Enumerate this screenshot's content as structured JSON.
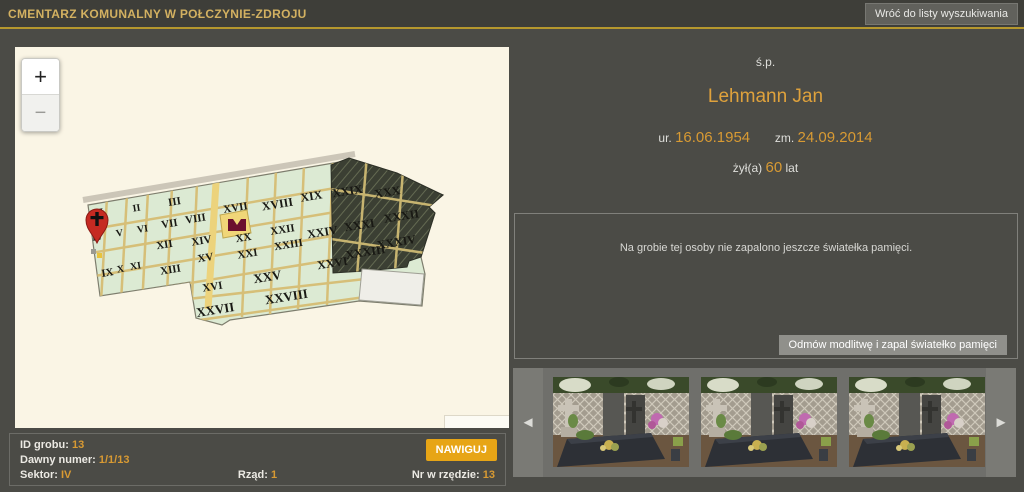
{
  "header": {
    "title": "CMENTARZ KOMUNALNY W POŁCZYNIE-ZDROJU",
    "back_button": "Wróć do listy wyszukiwania"
  },
  "map": {
    "zoom_in": "+",
    "zoom_out": "−",
    "marker_sector": "IV",
    "sectors": [
      {
        "label": "I",
        "x": 87,
        "y": 168,
        "s": 10
      },
      {
        "label": "II",
        "x": 122,
        "y": 164,
        "s": 10
      },
      {
        "label": "III",
        "x": 160,
        "y": 158,
        "s": 11
      },
      {
        "label": "IV",
        "x": 83,
        "y": 193,
        "s": 10
      },
      {
        "label": "V",
        "x": 105,
        "y": 189,
        "s": 10
      },
      {
        "label": "VI",
        "x": 128,
        "y": 185,
        "s": 10
      },
      {
        "label": "VII",
        "x": 155,
        "y": 180,
        "s": 11
      },
      {
        "label": "VIII",
        "x": 181,
        "y": 175,
        "s": 11
      },
      {
        "label": "IX",
        "x": 93,
        "y": 229,
        "s": 11
      },
      {
        "label": "X",
        "x": 106,
        "y": 225,
        "s": 10
      },
      {
        "label": "XI",
        "x": 121,
        "y": 222,
        "s": 10
      },
      {
        "label": "XII",
        "x": 150,
        "y": 201,
        "s": 11
      },
      {
        "label": "XIII",
        "x": 156,
        "y": 226,
        "s": 11
      },
      {
        "label": "XIV",
        "x": 187,
        "y": 197,
        "s": 11
      },
      {
        "label": "XV",
        "x": 191,
        "y": 214,
        "s": 11
      },
      {
        "label": "XVI",
        "x": 198,
        "y": 243,
        "s": 11
      },
      {
        "label": "XVII",
        "x": 221,
        "y": 164,
        "s": 11
      },
      {
        "label": "XVIII",
        "x": 263,
        "y": 161,
        "s": 12
      },
      {
        "label": "XIX",
        "x": 297,
        "y": 153,
        "s": 12
      },
      {
        "label": "XX",
        "x": 229,
        "y": 194,
        "s": 11
      },
      {
        "label": "XXI",
        "x": 233,
        "y": 210,
        "s": 11
      },
      {
        "label": "XXII",
        "x": 268,
        "y": 186,
        "s": 11
      },
      {
        "label": "XXIII",
        "x": 274,
        "y": 201,
        "s": 11
      },
      {
        "label": "XXIV",
        "x": 308,
        "y": 189,
        "s": 12
      },
      {
        "label": "XXV",
        "x": 253,
        "y": 234,
        "s": 13
      },
      {
        "label": "XXVI",
        "x": 318,
        "y": 220,
        "s": 12
      },
      {
        "label": "XXVII",
        "x": 201,
        "y": 267,
        "s": 13
      },
      {
        "label": "XXVIII",
        "x": 272,
        "y": 254,
        "s": 13
      },
      {
        "label": "XXIX",
        "x": 333,
        "y": 148,
        "s": 12
      },
      {
        "label": "XXX",
        "x": 373,
        "y": 149,
        "s": 12
      },
      {
        "label": "XXXI",
        "x": 345,
        "y": 182,
        "s": 12
      },
      {
        "label": "XXXII",
        "x": 387,
        "y": 173,
        "s": 12
      },
      {
        "label": "XXXIII",
        "x": 351,
        "y": 209,
        "s": 12
      },
      {
        "label": "XXXIV",
        "x": 382,
        "y": 199,
        "s": 12
      }
    ]
  },
  "person": {
    "prefix": "ś.p.",
    "name": "Lehmann Jan",
    "born_label": "ur.",
    "born_date": "16.06.1954",
    "died_label": "zm.",
    "died_date": "24.09.2014",
    "lived_label": "żył(a)",
    "lived_years": "60",
    "lived_suffix": "lat"
  },
  "memory": {
    "empty_message": "Na grobie tej osoby nie zapalono jeszcze światełka pamięci.",
    "light_candle_button": "Odmów modlitwę i zapal światełko pamięci"
  },
  "grave": {
    "id_label": "ID grobu:",
    "id_value": "13",
    "old_number_label": "Dawny numer:",
    "old_number_value": "1/1/13",
    "sector_label": "Sektor:",
    "sector_value": "IV",
    "row_label": "Rząd:",
    "row_value": "1",
    "row_number_label": "Nr w rzędzie:",
    "row_number_value": "13",
    "navigate_button": "NAWIGUJ"
  },
  "carousel": {
    "prev_icon": "◄",
    "next_icon": "►",
    "photos": [
      "grave-photo-1",
      "grave-photo-2",
      "grave-photo-3"
    ]
  },
  "colors": {
    "accent_gold": "#d89a33",
    "header_title": "#d3b161",
    "header_underline": "#b6982e",
    "navigate_button_bg": "#e7a516",
    "map_background": "#faf5e5",
    "sector_fill": "#dcead3",
    "path_tan": "#d6bf78",
    "marker_red": "#c52a22",
    "page_background": "#4b4b46"
  }
}
